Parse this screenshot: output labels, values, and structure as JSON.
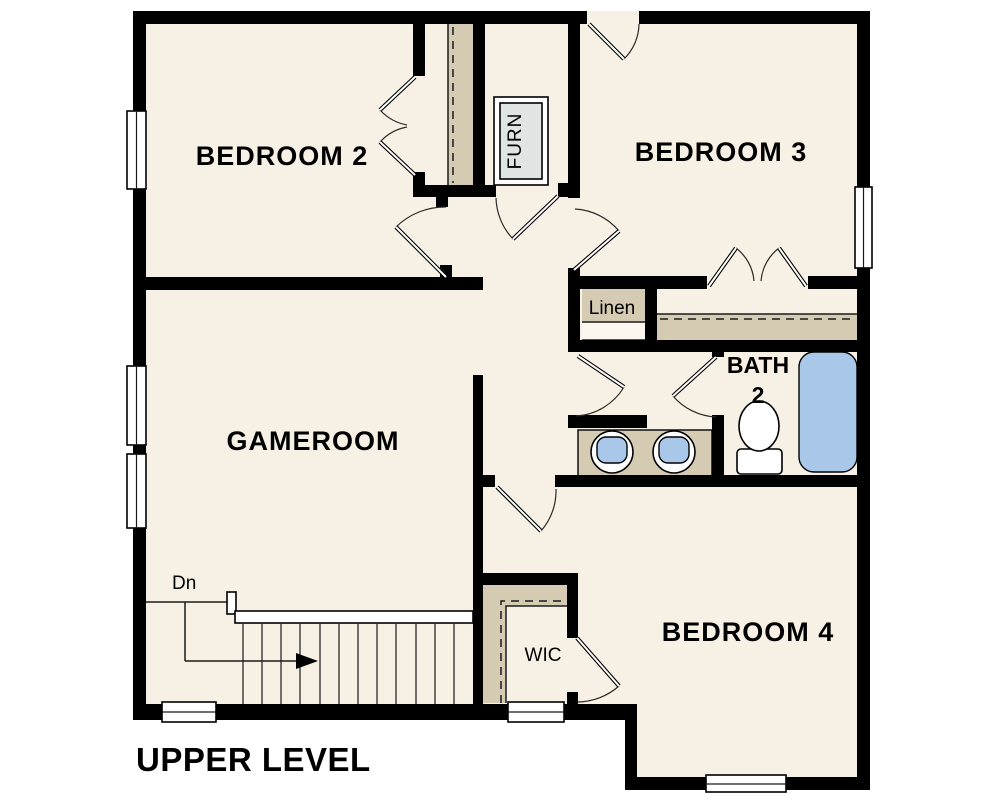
{
  "title": "UPPER LEVEL",
  "rooms": {
    "bedroom2": "BEDROOM 2",
    "bedroom3": "BEDROOM 3",
    "gameroom": "GAMEROOM",
    "bedroom4": "BEDROOM 4",
    "bath_line1": "BATH",
    "bath_line2": "2",
    "linen": "Linen",
    "furnace": "FURN",
    "wic": "WIC"
  },
  "stairs": {
    "direction_label": "Dn"
  },
  "colors": {
    "floor": "#f7f0e4",
    "wall": "#000000",
    "tan": "#d5cbb2",
    "blue": "#a9c8e9",
    "gray": "#e0e4e3",
    "bg": "#ffffff"
  }
}
